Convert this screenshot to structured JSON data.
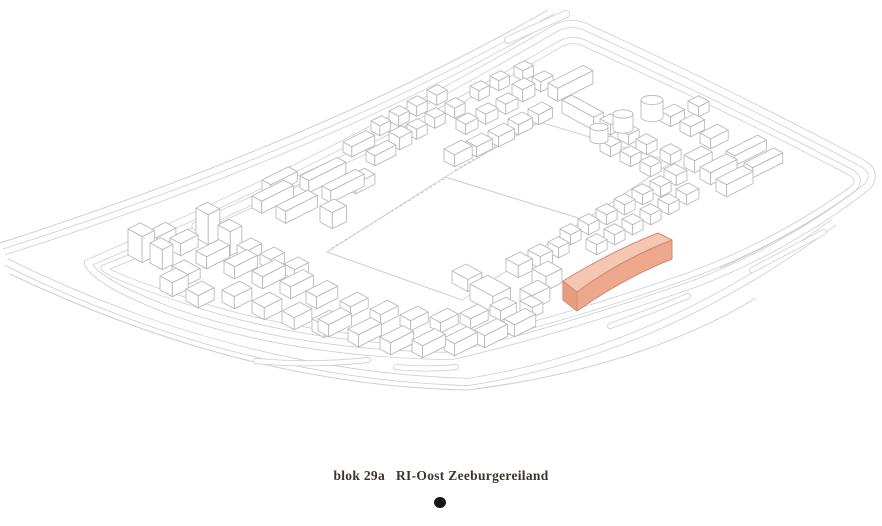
{
  "page": {
    "width": 882,
    "height": 526,
    "background": "#ffffff"
  },
  "caption": {
    "block": "blok 29a",
    "project": "RI-Oost Zeeburgereiland",
    "color": "#3b3531"
  },
  "marker": {
    "color": "#171513"
  },
  "drawing": {
    "road_ink": "#cbced4",
    "building_ink": "#b7bac0",
    "paper": "#ffffff",
    "lines": [
      "M 0,243 Q 320,140 548,10",
      "M 10,274 Q 245,386 468,390 Q 640,368 756,298",
      "M 720,268 Q 800,232 858,190"
    ],
    "roads": [
      {
        "d": "M 4,252 Q 330,148 556,16",
        "w": 7
      },
      {
        "d": "M 88,263 Q 330,160 556,28 Q 572,20 588,28 Q 736,96 862,163 Q 878,172 868,186 Q 788,248 694,284 Q 556,332 452,356 Q 292,354 168,310 Q 94,281 88,263 Z",
        "w": 8
      },
      {
        "d": "M 104,268 Q 338,174 560,44 Q 574,37 586,44 Q 728,108 850,172 Q 862,178 854,188 Q 780,242 688,276 Q 556,322 456,344 Q 300,340 184,300 Q 110,276 104,268 Z",
        "w": 7
      },
      {
        "d": "M 6,262 Q 235,375 468,382 Q 660,352 834,222",
        "w": 8
      }
    ],
    "strips": [
      {
        "d": "M 196,226 L 414,128",
        "w": 9
      },
      {
        "d": "M 256,361 Q 312,366 368,360",
        "w": 6
      },
      {
        "d": "M 396,367 Q 428,370 456,367",
        "w": 6
      },
      {
        "d": "M 610,326 Q 650,312 688,296",
        "w": 6
      },
      {
        "d": "M 752,270 L 824,232",
        "w": 6
      },
      {
        "d": "M 508,40 L 566,14",
        "w": 8
      }
    ],
    "dashed_edges": [
      "M 332,248 L 446,178",
      "M 455,170 L 538,122"
    ],
    "fields": [
      "327,252 445,177 585,220 462,300",
      "445,177 540,122 672,162 585,220"
    ],
    "boxes": [
      [
        128,
        255,
        16,
        14,
        26
      ],
      [
        150,
        263,
        14,
        12,
        20
      ],
      [
        146,
        242,
        12,
        22,
        10
      ],
      [
        170,
        250,
        12,
        20,
        12
      ],
      [
        172,
        276,
        18,
        14,
        10
      ],
      [
        196,
        238,
        14,
        13,
        30
      ],
      [
        218,
        249,
        14,
        13,
        24
      ],
      [
        196,
        263,
        12,
        26,
        12
      ],
      [
        224,
        273,
        12,
        26,
        12
      ],
      [
        252,
        283,
        12,
        26,
        12
      ],
      [
        280,
        293,
        12,
        26,
        12
      ],
      [
        306,
        303,
        12,
        24,
        12
      ],
      [
        237,
        255,
        12,
        16,
        10
      ],
      [
        260,
        264,
        12,
        16,
        10
      ],
      [
        284,
        274,
        12,
        16,
        10
      ],
      [
        222,
        302,
        14,
        20,
        12
      ],
      [
        252,
        313,
        14,
        20,
        12
      ],
      [
        282,
        323,
        14,
        20,
        12
      ],
      [
        312,
        331,
        14,
        20,
        12
      ],
      [
        160,
        290,
        14,
        18,
        14
      ],
      [
        186,
        301,
        14,
        18,
        12
      ],
      [
        252,
        208,
        11,
        36,
        12
      ],
      [
        276,
        218,
        11,
        36,
        12
      ],
      [
        300,
        188,
        10,
        42,
        12
      ],
      [
        322,
        198,
        10,
        38,
        12
      ],
      [
        262,
        190,
        10,
        30,
        10
      ],
      [
        320,
        222,
        14,
        16,
        16
      ],
      [
        345,
        188,
        12,
        22,
        10
      ],
      [
        343,
        152,
        10,
        26,
        10
      ],
      [
        366,
        161,
        10,
        24,
        10
      ],
      [
        389,
        144,
        12,
        14,
        12
      ],
      [
        407,
        134,
        11,
        12,
        10
      ],
      [
        425,
        123,
        11,
        12,
        10
      ],
      [
        389,
        121,
        11,
        12,
        10
      ],
      [
        407,
        111,
        11,
        12,
        10
      ],
      [
        427,
        100,
        11,
        12,
        10
      ],
      [
        445,
        113,
        11,
        12,
        10
      ],
      [
        371,
        131,
        10,
        12,
        10
      ],
      [
        444,
        161,
        12,
        20,
        12
      ],
      [
        466,
        151,
        12,
        18,
        10
      ],
      [
        488,
        141,
        12,
        18,
        10
      ],
      [
        456,
        129,
        11,
        14,
        10
      ],
      [
        476,
        119,
        11,
        14,
        10
      ],
      [
        496,
        109,
        11,
        14,
        10
      ],
      [
        470,
        96,
        10,
        12,
        10
      ],
      [
        490,
        86,
        10,
        12,
        10
      ],
      [
        512,
        96,
        12,
        14,
        12
      ],
      [
        514,
        76,
        10,
        12,
        10
      ],
      [
        532,
        87,
        10,
        14,
        10
      ],
      [
        508,
        129,
        12,
        16,
        10
      ],
      [
        528,
        119,
        12,
        16,
        10
      ],
      [
        548,
        96,
        11,
        40,
        13
      ],
      [
        562,
        113,
        36,
        11,
        13
      ],
      [
        600,
        129,
        12,
        12,
        10
      ],
      [
        618,
        139,
        12,
        12,
        10
      ],
      [
        636,
        149,
        12,
        12,
        10
      ],
      [
        600,
        151,
        12,
        12,
        10
      ],
      [
        620,
        161,
        12,
        12,
        10
      ],
      [
        640,
        171,
        12,
        12,
        10
      ],
      [
        660,
        159,
        12,
        12,
        10
      ],
      [
        664,
        179,
        14,
        12,
        10
      ],
      [
        684,
        167,
        12,
        20,
        12
      ],
      [
        700,
        179,
        12,
        30,
        12
      ],
      [
        716,
        191,
        12,
        30,
        12
      ],
      [
        660,
        121,
        12,
        16,
        10
      ],
      [
        680,
        131,
        12,
        16,
        10
      ],
      [
        700,
        143,
        12,
        20,
        10
      ],
      [
        726,
        161,
        10,
        36,
        10
      ],
      [
        744,
        173,
        10,
        34,
        10
      ],
      [
        688,
        111,
        12,
        12,
        10
      ],
      [
        560,
        239,
        12,
        12,
        10
      ],
      [
        578,
        229,
        12,
        12,
        10
      ],
      [
        596,
        219,
        12,
        12,
        10
      ],
      [
        614,
        209,
        12,
        12,
        10
      ],
      [
        632,
        199,
        12,
        12,
        10
      ],
      [
        650,
        191,
        12,
        12,
        10
      ],
      [
        586,
        249,
        12,
        12,
        10
      ],
      [
        604,
        239,
        12,
        12,
        10
      ],
      [
        622,
        229,
        12,
        12,
        10
      ],
      [
        640,
        219,
        12,
        12,
        10
      ],
      [
        658,
        209,
        12,
        12,
        10
      ],
      [
        676,
        199,
        12,
        14,
        10
      ],
      [
        528,
        262,
        14,
        14,
        12
      ],
      [
        548,
        252,
        12,
        12,
        10
      ],
      [
        318,
        331,
        12,
        26,
        12
      ],
      [
        348,
        341,
        12,
        26,
        12
      ],
      [
        380,
        349,
        12,
        26,
        12
      ],
      [
        412,
        352,
        12,
        26,
        12
      ],
      [
        444,
        350,
        12,
        26,
        12
      ],
      [
        474,
        342,
        12,
        26,
        12
      ],
      [
        504,
        331,
        12,
        24,
        12
      ],
      [
        340,
        311,
        12,
        20,
        10
      ],
      [
        370,
        319,
        12,
        20,
        10
      ],
      [
        400,
        325,
        12,
        20,
        10
      ],
      [
        430,
        327,
        12,
        20,
        10
      ],
      [
        460,
        323,
        12,
        20,
        10
      ],
      [
        490,
        315,
        12,
        18,
        10
      ],
      [
        520,
        303,
        14,
        20,
        14
      ],
      [
        532,
        283,
        16,
        18,
        14
      ],
      [
        506,
        271,
        14,
        16,
        12
      ],
      [
        520,
        311,
        14,
        12,
        10
      ],
      [
        470,
        300,
        26,
        20,
        16
      ],
      [
        452,
        283,
        18,
        16,
        12
      ]
    ],
    "cylinders": [
      [
        652,
        100,
        11,
        17
      ],
      [
        623,
        114,
        10,
        15
      ],
      [
        599,
        127,
        9,
        13
      ]
    ],
    "highlight_block": {
      "label": "blok 29a",
      "top_face": "M 563,281 Q 612,251 658,233 L 672,240 Q 620,260 577,292 Z",
      "front_face": "M 577,292 Q 620,260 672,240 L 672,259 Q 622,279 577,311 Z",
      "end_face": "M 563,281 L 577,292 L 577,311 L 563,300 Z",
      "top_color": "#f5c6b1",
      "front_color": "#eda78d",
      "end_color": "#e89d81",
      "edge_color": "#d28a6e"
    }
  }
}
